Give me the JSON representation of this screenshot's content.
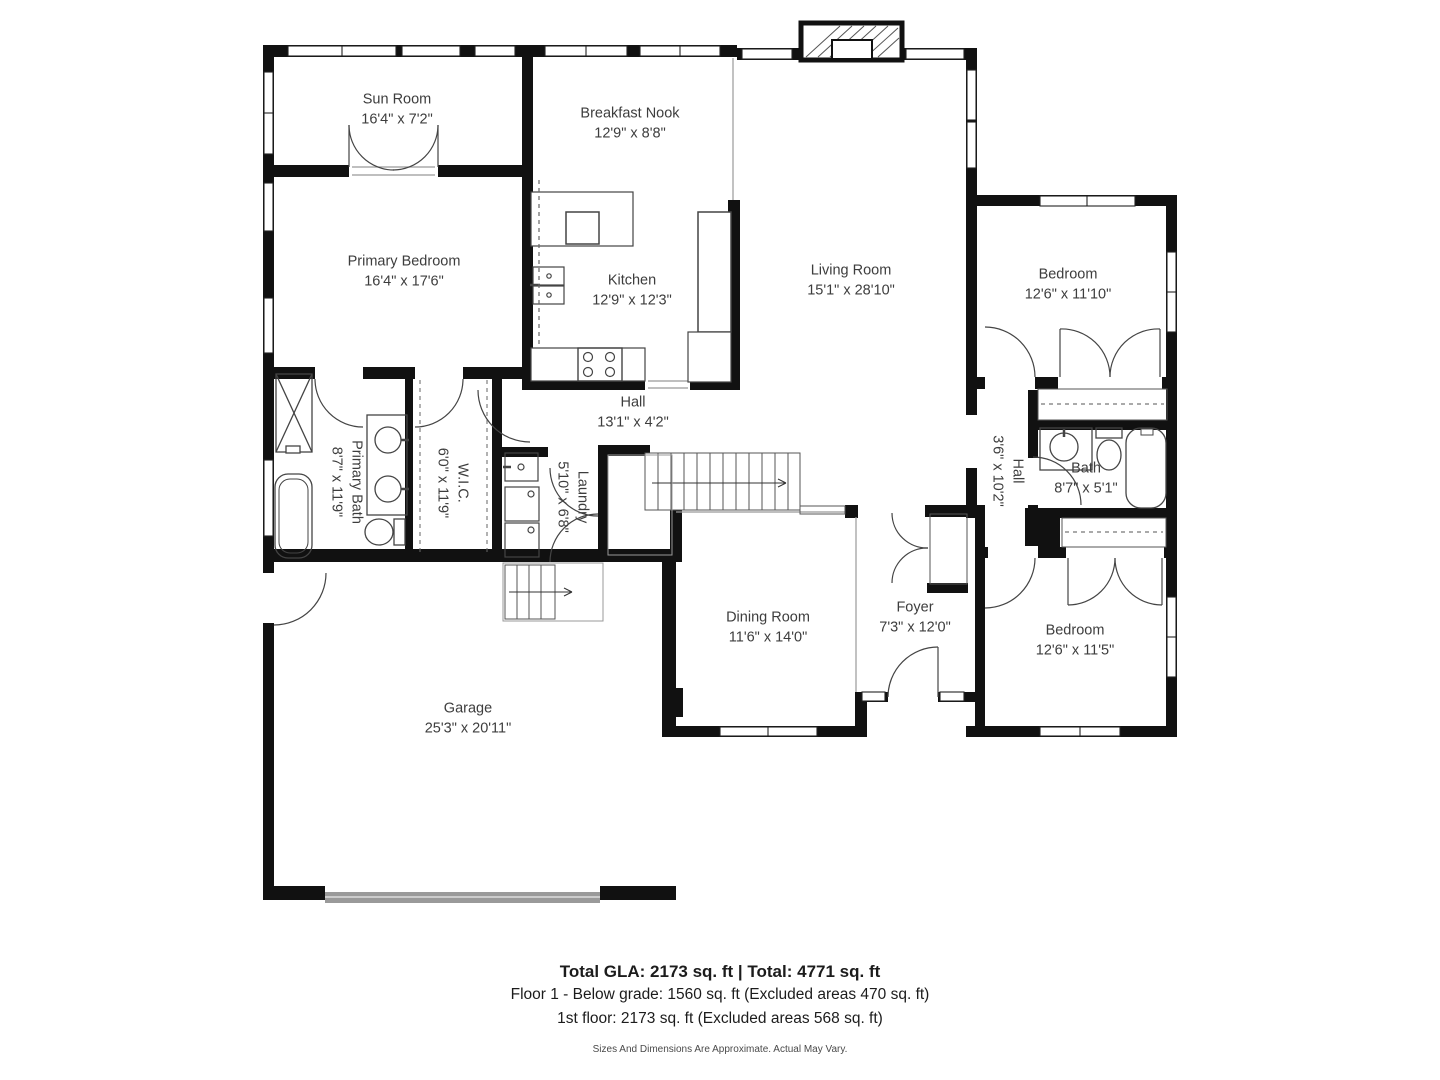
{
  "meta": {
    "type": "floor-plan",
    "background_color": "#ffffff",
    "wall_color": "#111111",
    "text_color": "#3d3d3d",
    "garage_door_color": "#9a9a9a"
  },
  "rooms": [
    {
      "name": "Sun Room",
      "dims": "16'4\" x 7'2\""
    },
    {
      "name": "Breakfast Nook",
      "dims": "12'9\" x 8'8\""
    },
    {
      "name": "Primary Bedroom",
      "dims": "16'4\" x 17'6\""
    },
    {
      "name": "Kitchen",
      "dims": "12'9\" x 12'3\""
    },
    {
      "name": "Living Room",
      "dims": "15'1\" x 28'10\""
    },
    {
      "name": "Bedroom",
      "dims": "12'6\" x 11'10\""
    },
    {
      "name": "Hall",
      "dims": "13'1\" x 4'2\""
    },
    {
      "name": "Primary Bath",
      "dims": "8'7\" x 11'9\""
    },
    {
      "name": "W.I.C.",
      "dims": "6'0\" x 11'9\""
    },
    {
      "name": "Laundry",
      "dims": "5'10\" x 6'8\""
    },
    {
      "name": "Hall",
      "dims": "3'6\" x 10'2\""
    },
    {
      "name": "Bath",
      "dims": "8'7\" x 5'1\""
    },
    {
      "name": "Dining Room",
      "dims": "11'6\" x 14'0\""
    },
    {
      "name": "Foyer",
      "dims": "7'3\" x 12'0\""
    },
    {
      "name": "Bedroom",
      "dims": "12'6\" x 11'5\""
    },
    {
      "name": "Garage",
      "dims": "25'3\" x 20'11\""
    }
  ],
  "footer": {
    "line1": "Total GLA: 2173 sq. ft | Total: 4771 sq. ft",
    "line2": "Floor 1 - Below grade: 1560 sq. ft (Excluded areas 470 sq. ft)",
    "line3": "1st floor: 2173 sq. ft (Excluded areas 568 sq. ft)",
    "disclaimer": "Sizes And Dimensions Are Approximate. Actual May Vary."
  }
}
